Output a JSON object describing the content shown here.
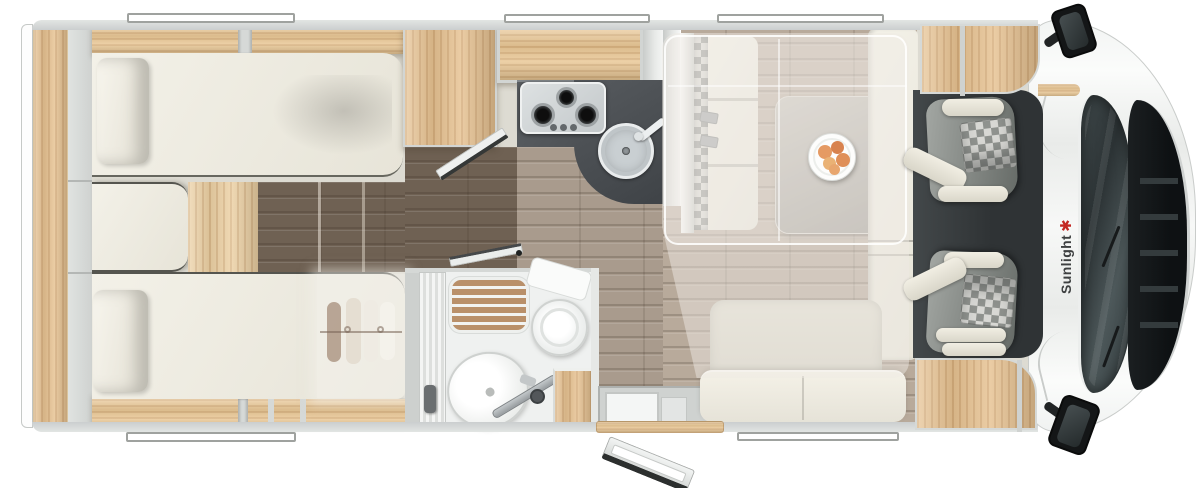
{
  "brand": {
    "text": "Sunlight",
    "icon": "sun-logo-icon",
    "icon_glyph": "✱",
    "icon_color": "#c32722",
    "text_color": "#3e4041"
  },
  "floorplan": {
    "view": "top-down-motorhome-layout",
    "zones": [
      {
        "name": "rear-bedroom",
        "fixtures": [
          "twin-bed-top",
          "twin-bed-bottom",
          "pillows",
          "center-step-cushion",
          "overhead-cabinets",
          "wardrobe-ghost-clothes"
        ]
      },
      {
        "name": "kitchen",
        "fixtures": [
          "wardrobe-block",
          "gas-hob-3-burner",
          "control-knobs",
          "round-sink",
          "faucet",
          "dark-worktop"
        ]
      },
      {
        "name": "bathroom",
        "fixtures": [
          "shower-wood-grate",
          "toilet",
          "cistern",
          "washbasin",
          "shower-screen",
          "tambour-door"
        ]
      },
      {
        "name": "dinette",
        "fixtures": [
          "forward-bench-with-headrests",
          "belt-brackets",
          "dinette-table",
          "fruit-plate",
          "l-shaped-sofa",
          "drop-down-bed-ghost"
        ]
      },
      {
        "name": "cab",
        "fixtures": [
          "swivel-seat-left",
          "swivel-seat-right",
          "windshield",
          "front-grille",
          "side-mirror-top",
          "side-mirror-bottom"
        ]
      },
      {
        "name": "entry",
        "fixtures": [
          "entry-door-open",
          "entry-steps",
          "wood-sill"
        ]
      }
    ],
    "windows": {
      "top": 3,
      "bottom": 2
    },
    "entry_steps": 2
  },
  "palette": {
    "body_wall": "#d4d7d5",
    "wood_light": "#e8c593",
    "floor_dark": "#6f6153",
    "floor_mid": "#a99b8d",
    "floor_dinette": "#b8aa9b",
    "upholstery_cream": "#ece9de",
    "worktop_dark": "#4c5054",
    "stainless": "#cfd4d6",
    "cab_dark": "#33383a",
    "ghost_overlay": "rgba(238,235,227,0.5)",
    "fruit_orange": "#e39a66"
  }
}
